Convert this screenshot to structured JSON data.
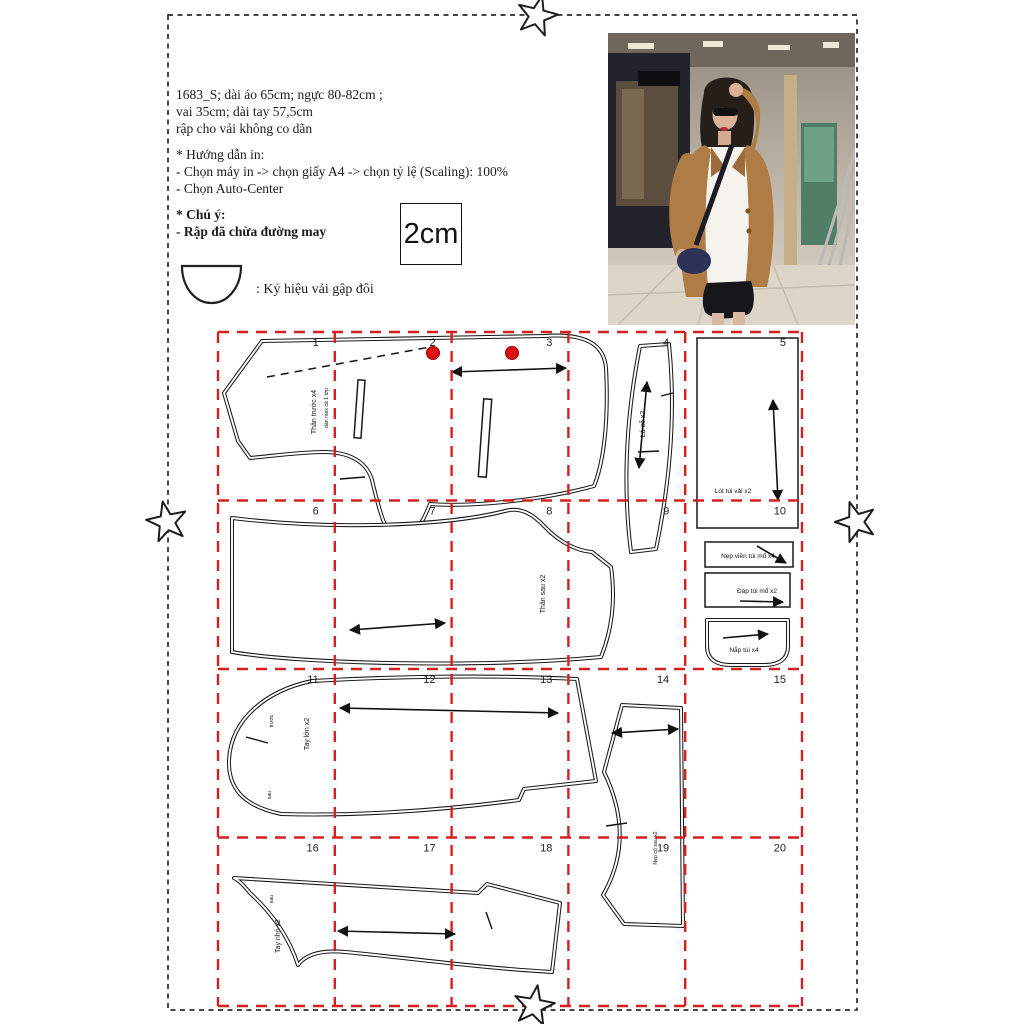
{
  "info": {
    "spec_lines": [
      "1683_S; dài áo 65cm; ngực 80-82cm ;",
      "vai 35cm; dài tay 57,5cm",
      "rập cho vải không co dãn"
    ],
    "print_guide": {
      "title": "* Hướng dẫn in:",
      "lines": [
        "- Chọn máy in -> chọn giấy A4 -> chọn tỷ lệ (Scaling): 100%",
        "- Chọn Auto-Center"
      ]
    },
    "note": {
      "title": "* Chú ý:",
      "line": "- Rập đã chừa đường may"
    },
    "scale_box_label": "2cm",
    "fold_symbol_caption": ": Ký hiệu vải gập đôi"
  },
  "grid": {
    "numbers": [
      "1",
      "2",
      "3",
      "4",
      "5",
      "6",
      "7",
      "8",
      "9",
      "10",
      "11",
      "12",
      "13",
      "14",
      "15",
      "16",
      "17",
      "18",
      "19",
      "20"
    ],
    "line_color": "#d42020"
  },
  "pieces": {
    "front": {
      "label1": "Thân trước x4",
      "label2": "dán mex cả 1 lớp"
    },
    "collar": {
      "label": "Lá cổ x2"
    },
    "pocket_bag": {
      "label": "Lót túi vải x2"
    },
    "back": {
      "label": "Thân sau x2"
    },
    "welt": {
      "label": "Nẹp viền túi mổ x4"
    },
    "pocket_facing": {
      "label": "Đáp túi mổ x2"
    },
    "flap": {
      "label": "Nắp túi x4"
    },
    "big_sleeve": {
      "label": "Tay lớn x2",
      "front_mark": "trước",
      "back_mark": "sau"
    },
    "side_panel": {
      "label": "Nẹp cổ sau x2"
    },
    "small_sleeve": {
      "label": "Tay nhỏ x2",
      "back_mark": "sau"
    }
  },
  "colors": {
    "grid_red": "#d42020",
    "button_red": "#dd1111",
    "blazer_tan": "#b07c45"
  }
}
